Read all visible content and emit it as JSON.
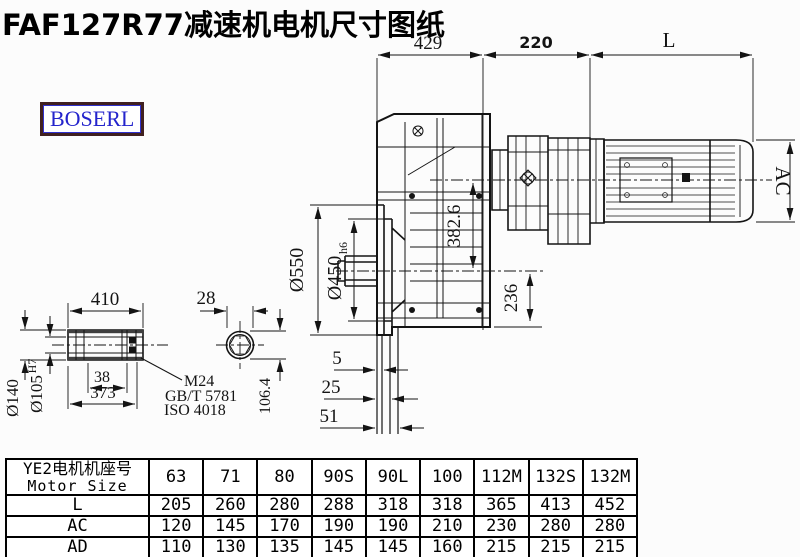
{
  "title": "FAF127R77减速机电机尺寸图纸",
  "brand": {
    "logo_text": "BOSERL"
  },
  "colors": {
    "line": "#141414",
    "logo_text": "#2424cc",
    "logo_border": "#402020",
    "background": "#fcfcfc"
  },
  "dims": {
    "top_429": "429",
    "top_220": "220",
    "motor_length": "L",
    "motor_height": "AC",
    "axis_offset": "382.6",
    "bottom_offset": "236",
    "flange_od": "Ø550",
    "flange_spigot": "Ø450",
    "flange_spigot_tol": "h6",
    "step_5": "5",
    "step_25": "25",
    "step_51": "51",
    "shaft_length": "410",
    "shaft_end_width": "28",
    "shaft_od": "Ø140",
    "shaft_bore": "Ø105",
    "shaft_bore_tol": "H7",
    "key_38": "38",
    "key_373": "373",
    "across_flats": "106.4",
    "bolt_callout_line1": "M24",
    "bolt_callout_line2": "GB/T 5781",
    "bolt_callout_line3": "ISO 4018"
  },
  "table": {
    "header_line1": "YE2电机机座号",
    "header_line2": "Motor Size",
    "columns": [
      "63",
      "71",
      "80",
      "90S",
      "90L",
      "100",
      "112M",
      "132S",
      "132M"
    ],
    "rows": [
      {
        "label": "L",
        "values": [
          "205",
          "260",
          "280",
          "288",
          "318",
          "318",
          "365",
          "413",
          "452"
        ]
      },
      {
        "label": "AC",
        "values": [
          "120",
          "145",
          "170",
          "190",
          "190",
          "210",
          "230",
          "280",
          "280"
        ]
      },
      {
        "label": "AD",
        "values": [
          "110",
          "130",
          "135",
          "145",
          "145",
          "160",
          "215",
          "215",
          "215"
        ]
      }
    ]
  }
}
